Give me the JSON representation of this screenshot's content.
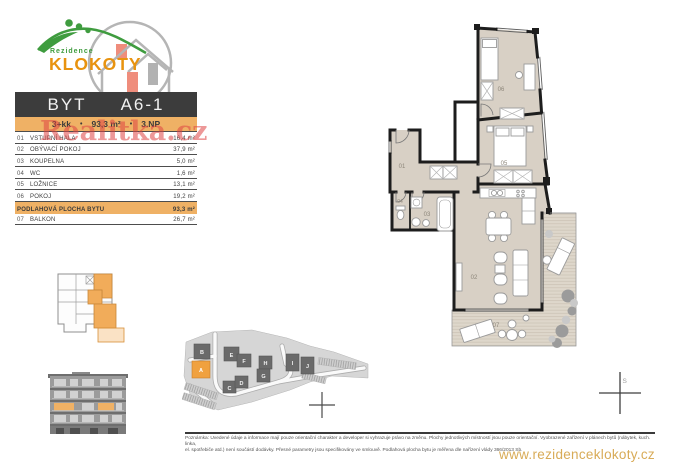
{
  "brand": {
    "name_top": "Rezidence",
    "name_main": "KLOKOTY"
  },
  "unit_header": {
    "type_label": "BYT",
    "unit_code": "A6-1",
    "disposition": "3+kk",
    "total_area": "93,3 m²",
    "floor": "3.NP",
    "separator": "•"
  },
  "room_table": {
    "rows": [
      {
        "num": "01",
        "name": "VSTUPNÍ HALA",
        "area": "16,4 m²"
      },
      {
        "num": "02",
        "name": "OBÝVACÍ POKOJ",
        "area": "37,9 m²"
      },
      {
        "num": "03",
        "name": "KOUPELNA",
        "area": "5,0 m²"
      },
      {
        "num": "04",
        "name": "WC",
        "area": "1,6 m²"
      },
      {
        "num": "05",
        "name": "LOŽNICE",
        "area": "13,1 m²"
      },
      {
        "num": "06",
        "name": "POKOJ",
        "area": "19,2 m²"
      }
    ],
    "total_row": {
      "label": "PODLAHOVÁ PLOCHA BYTU",
      "area": "93,3 m²"
    },
    "balcony_row": {
      "num": "07",
      "name": "BALKON",
      "area": "26,7 m²"
    }
  },
  "watermark": {
    "text": "Realitka.cz"
  },
  "floor_plan": {
    "labels": [
      "01",
      "02",
      "03",
      "04",
      "05",
      "06",
      "07"
    ],
    "north_label": "S"
  },
  "site_plan": {
    "building_labels": [
      "B",
      "A",
      "E",
      "F",
      "H",
      "G",
      "C",
      "D",
      "I",
      "J"
    ],
    "highlighted_building": "A"
  },
  "footer": {
    "note_line1": "Poznámka: Uvedené údaje a informace mají pouze orientační charakter a developer si vyhrazuje právo na změnu. Plochy jednotlivých místností jsou pouze orientační. Vyobrazené zařízení v plánech bytů (nábytek, kuch. linka,",
    "note_line2": "el. spotřebiče atd.) není součástí dodávky. Přesné parametry jsou specifikovány ve smlouvě. Podlahová plocha bytu je měřena dle nařízení vlády 366/2013 Sb.",
    "website": "www.rezidenceklokoty.cz"
  },
  "colors": {
    "accent_orange": "#efb165",
    "dark_bar": "#3c3c3c",
    "watermark_red": "#de4444",
    "site_orange": "#f0a13f",
    "logo_orange": "#e8930f",
    "logo_green": "#3f9c3f",
    "floor_beige": "#d8d0c5",
    "website_gold": "#d8ab57"
  }
}
